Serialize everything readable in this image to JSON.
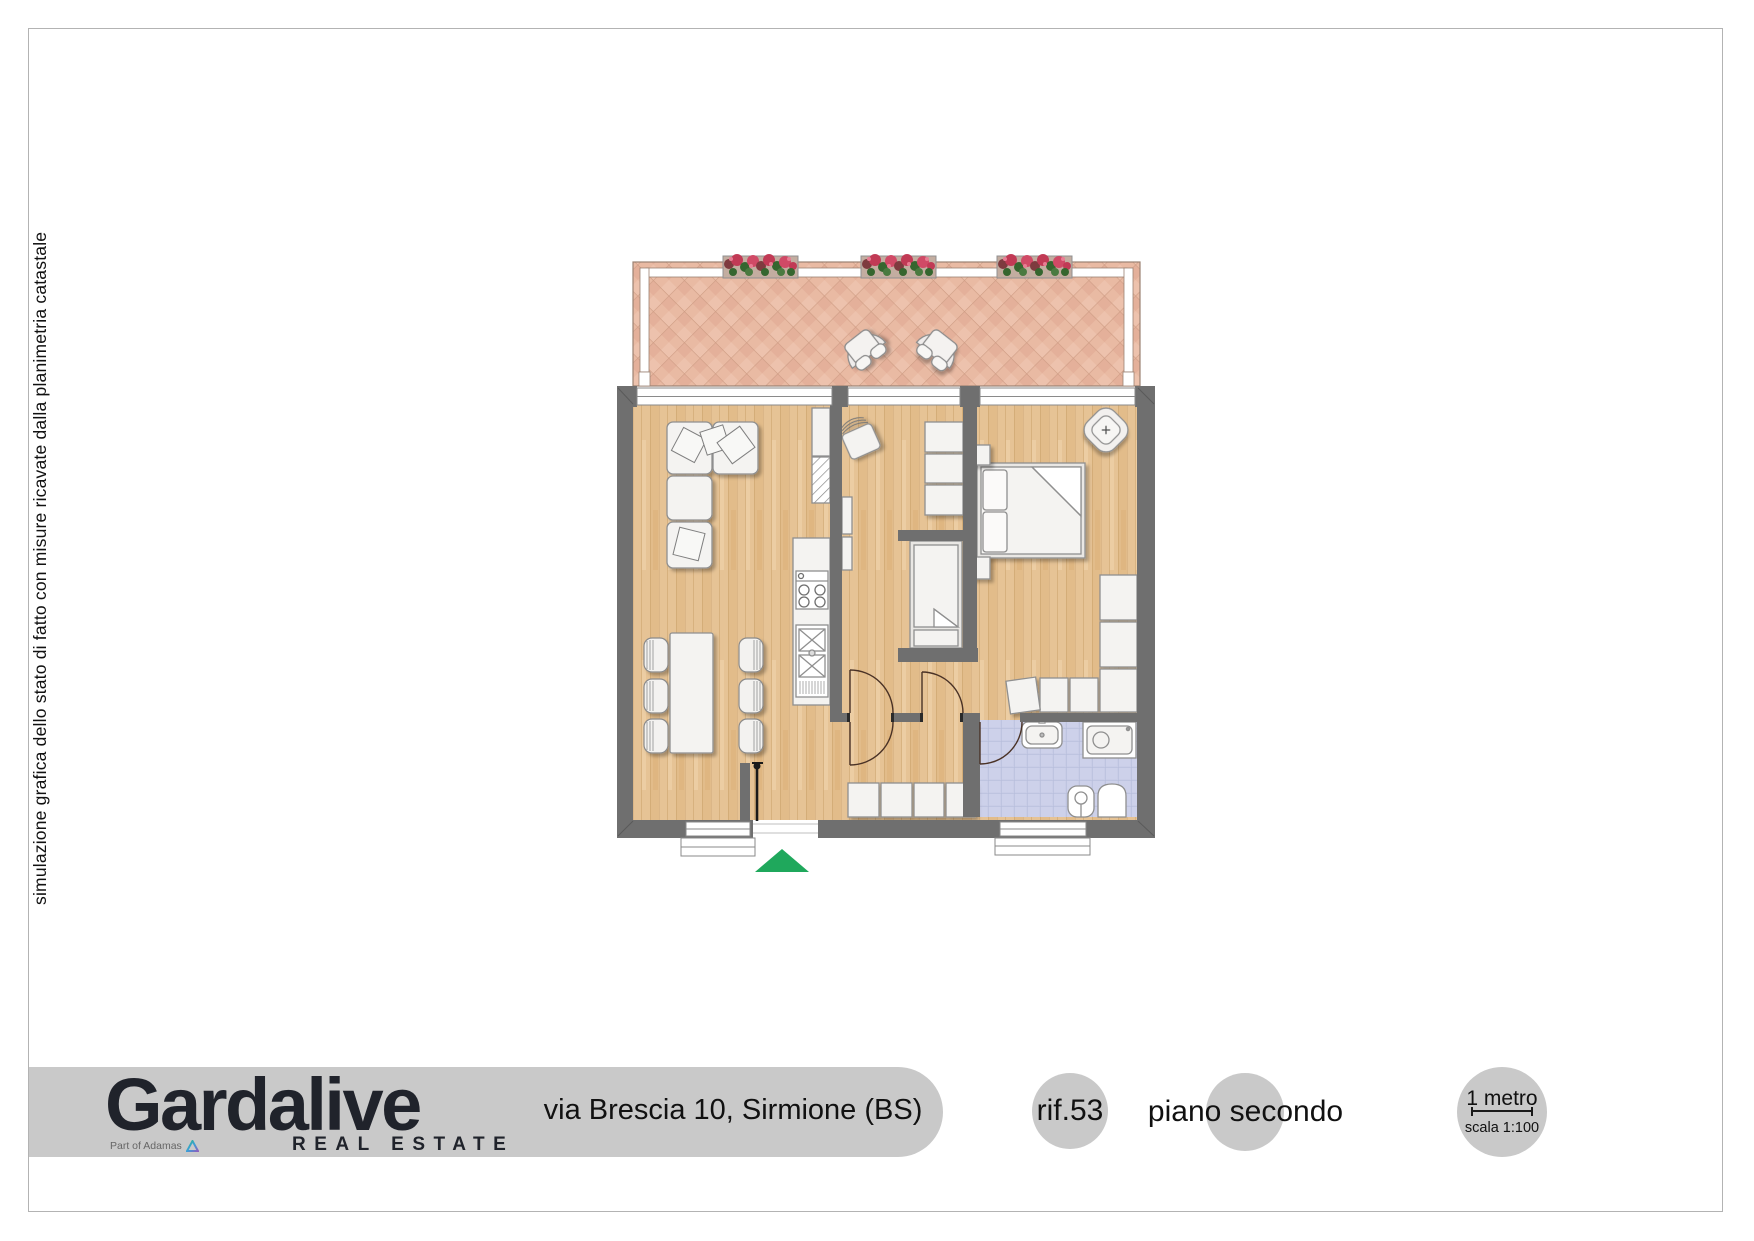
{
  "sidenote": "simulazione grafica dello stato di fatto con misure ricavate dalla planimetria catastale",
  "footer": {
    "brand": {
      "name": "Gardalive",
      "tagline": "REAL ESTATE",
      "partner": "Part of Adamas"
    },
    "address": "via Brescia 10, Sirmione (BS)",
    "reference": "rif.53",
    "floor_label": "piano secondo",
    "scale": {
      "length": "1 metro",
      "ratio": "scala 1:100"
    }
  },
  "plan": {
    "colors": {
      "wall": "#6f6f6f",
      "wood_floor": "#e6c395",
      "terrace_tile": "#e9baa3",
      "bathroom_tile": "#c9cde7",
      "entrance_arrow": "#1fa85c",
      "footer_band": "#c9c9c9",
      "furniture_fill": "#f4f3f1",
      "furniture_stroke": "#8f8f8f"
    },
    "markers": {
      "entrance_arrow": "green-triangle-pointing-up"
    }
  }
}
